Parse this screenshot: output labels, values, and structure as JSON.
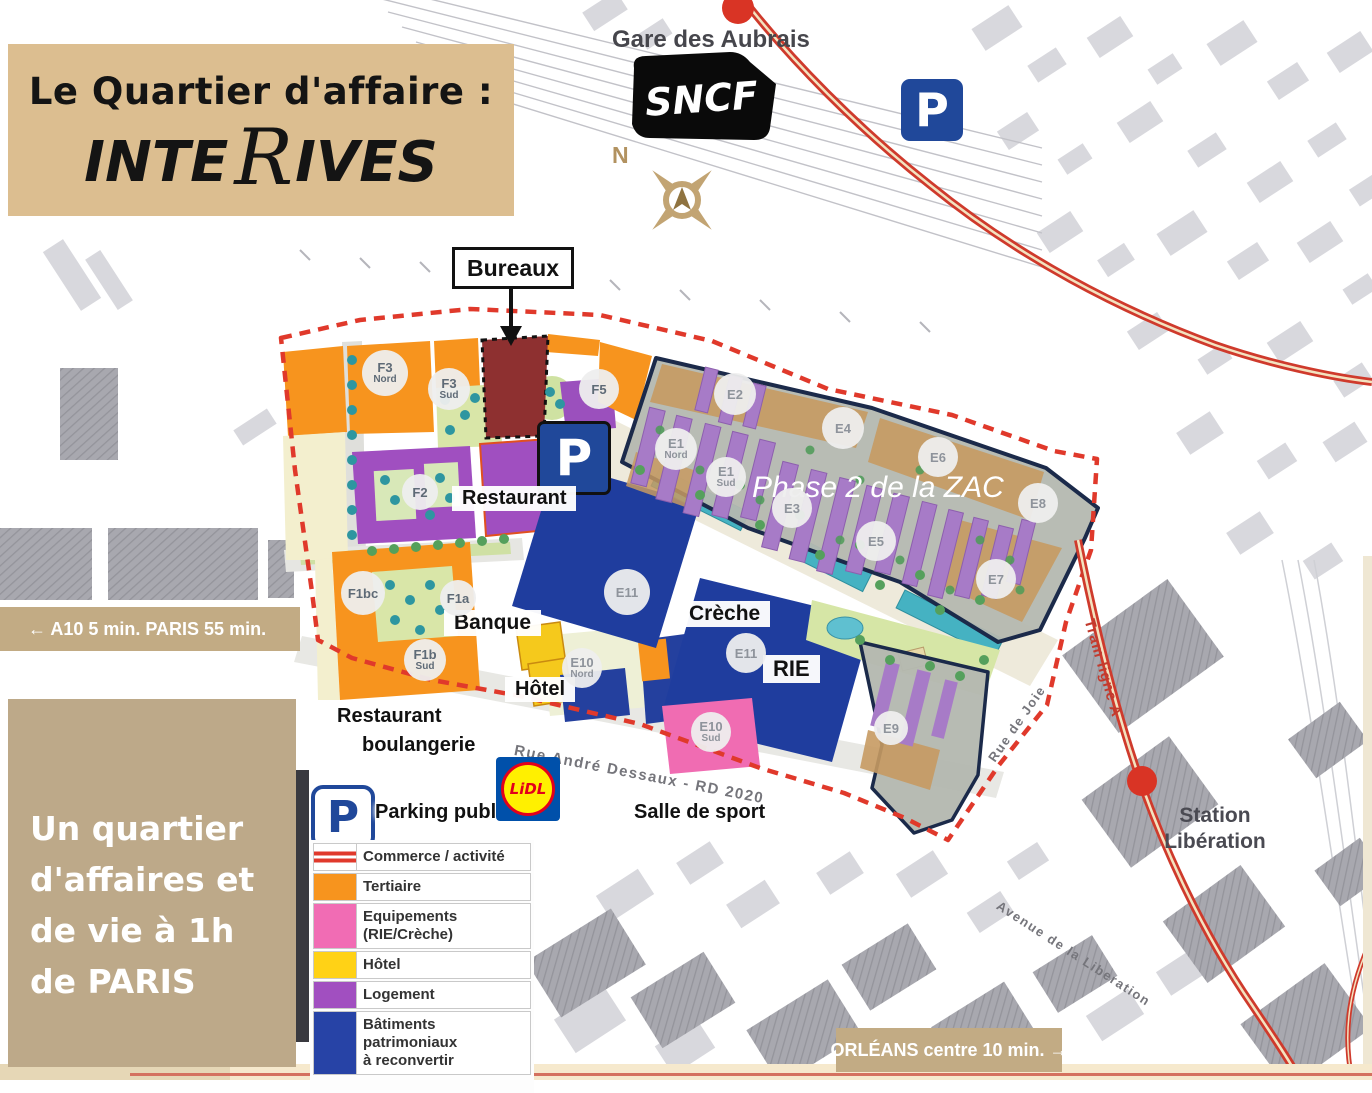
{
  "header": {
    "title_line": "Le Quartier d'affaire :",
    "brand": {
      "pre": "INTE",
      "r": "R",
      "post": "IVES"
    }
  },
  "map_labels": {
    "gare": "Gare des Aubrais",
    "sncf": "SNCF",
    "compass_n": "N",
    "p": "P",
    "phase2": "Phase 2 de la ZAC",
    "rue_andre_dessaux": "Rue André Dessaux - RD 2020",
    "tram_ligne_a": "Tram ligne A",
    "station_liberation": "Station Libération",
    "rue_de_joie": "Rue de Joie",
    "avenue_liberation": "Avenue de la Liberation"
  },
  "callouts": {
    "bureaux": "Bureaux",
    "restaurant": "Restaurant",
    "banque": "Banque",
    "creche": "Crèche",
    "rie": "RIE",
    "hotel": "Hôtel",
    "restaurant_boulangerie_1": "Restaurant",
    "restaurant_boulangerie_2": "boulangerie",
    "parking_public": "Parking public",
    "salle_de_sport": "Salle de sport"
  },
  "lidl": {
    "text": "LiDL"
  },
  "banners": {
    "a10": "← A10 5 min. PARIS 55 min.",
    "orleans": "ORLÉANS centre 10 min. →",
    "info_box": "Un quartier d'affaires et de vie à 1h de PARIS"
  },
  "parcels": [
    {
      "label": "F3",
      "sub": "Nord",
      "x": 385,
      "y": 373,
      "d": 46
    },
    {
      "label": "F3",
      "sub": "Sud",
      "x": 449,
      "y": 389,
      "d": 42
    },
    {
      "label": "F5",
      "x": 599,
      "y": 389,
      "d": 40
    },
    {
      "label": "F2",
      "x": 420,
      "y": 492,
      "d": 36
    },
    {
      "label": "F1bc",
      "x": 363,
      "y": 593,
      "d": 44
    },
    {
      "label": "F1a",
      "x": 458,
      "y": 598,
      "d": 36
    },
    {
      "label": "F1b",
      "sub": "Sud",
      "x": 425,
      "y": 660,
      "d": 42
    },
    {
      "label": "E10",
      "sub": "Nord",
      "x": 582,
      "y": 668,
      "d": 40
    },
    {
      "label": "E10",
      "sub": "Sud",
      "x": 711,
      "y": 732,
      "d": 40
    },
    {
      "label": "E11",
      "x": 627,
      "y": 592,
      "d": 46
    },
    {
      "label": "E11",
      "x": 746,
      "y": 653,
      "d": 40
    },
    {
      "label": "E2",
      "x": 735,
      "y": 394,
      "d": 42
    },
    {
      "label": "E1",
      "sub": "Nord",
      "x": 676,
      "y": 449,
      "d": 42
    },
    {
      "label": "E1",
      "sub": "Sud",
      "x": 726,
      "y": 477,
      "d": 40
    },
    {
      "label": "E3",
      "x": 792,
      "y": 508,
      "d": 40
    },
    {
      "label": "E4",
      "x": 843,
      "y": 428,
      "d": 42
    },
    {
      "label": "E5",
      "x": 876,
      "y": 541,
      "d": 40
    },
    {
      "label": "E6",
      "x": 938,
      "y": 457,
      "d": 40
    },
    {
      "label": "E7",
      "x": 996,
      "y": 579,
      "d": 40
    },
    {
      "label": "E8",
      "x": 1038,
      "y": 503,
      "d": 40
    },
    {
      "label": "E9",
      "x": 891,
      "y": 728,
      "d": 34
    }
  ],
  "legend": {
    "items": [
      {
        "label": "Commerce / activité",
        "style": "lines",
        "color": "#e0392c"
      },
      {
        "label": "Tertiaire",
        "style": "fill",
        "color": "#f7941e"
      },
      {
        "label": "Equipements (RIE/Crèche)",
        "style": "fill",
        "color": "#f16cb4"
      },
      {
        "label": "Hôtel",
        "style": "fill",
        "color": "#ffd216"
      },
      {
        "label": "Logement",
        "style": "fill",
        "color": "#a14fc0"
      },
      {
        "label": "Bâtiments patrimoniaux\nà reconvertir",
        "style": "fill",
        "color": "#2743a6"
      }
    ]
  },
  "colors": {
    "title_tan": "#dcbe90",
    "banner_tan": "#c2ab84",
    "info_tan": "#bda989",
    "tram_red": "#d63a2c",
    "boundary_red": "#e0392b",
    "navy_building": "#1f3d9e",
    "orange_tertiaire": "#f7941e",
    "pink_equipement": "#f16cb4",
    "yellow_hotel": "#f5c91c",
    "purple_logement": "#a04fc0",
    "phase2_gray": "#b4b8b0",
    "phase2_tan": "#c79a62",
    "parking_navy": "#20489a"
  }
}
